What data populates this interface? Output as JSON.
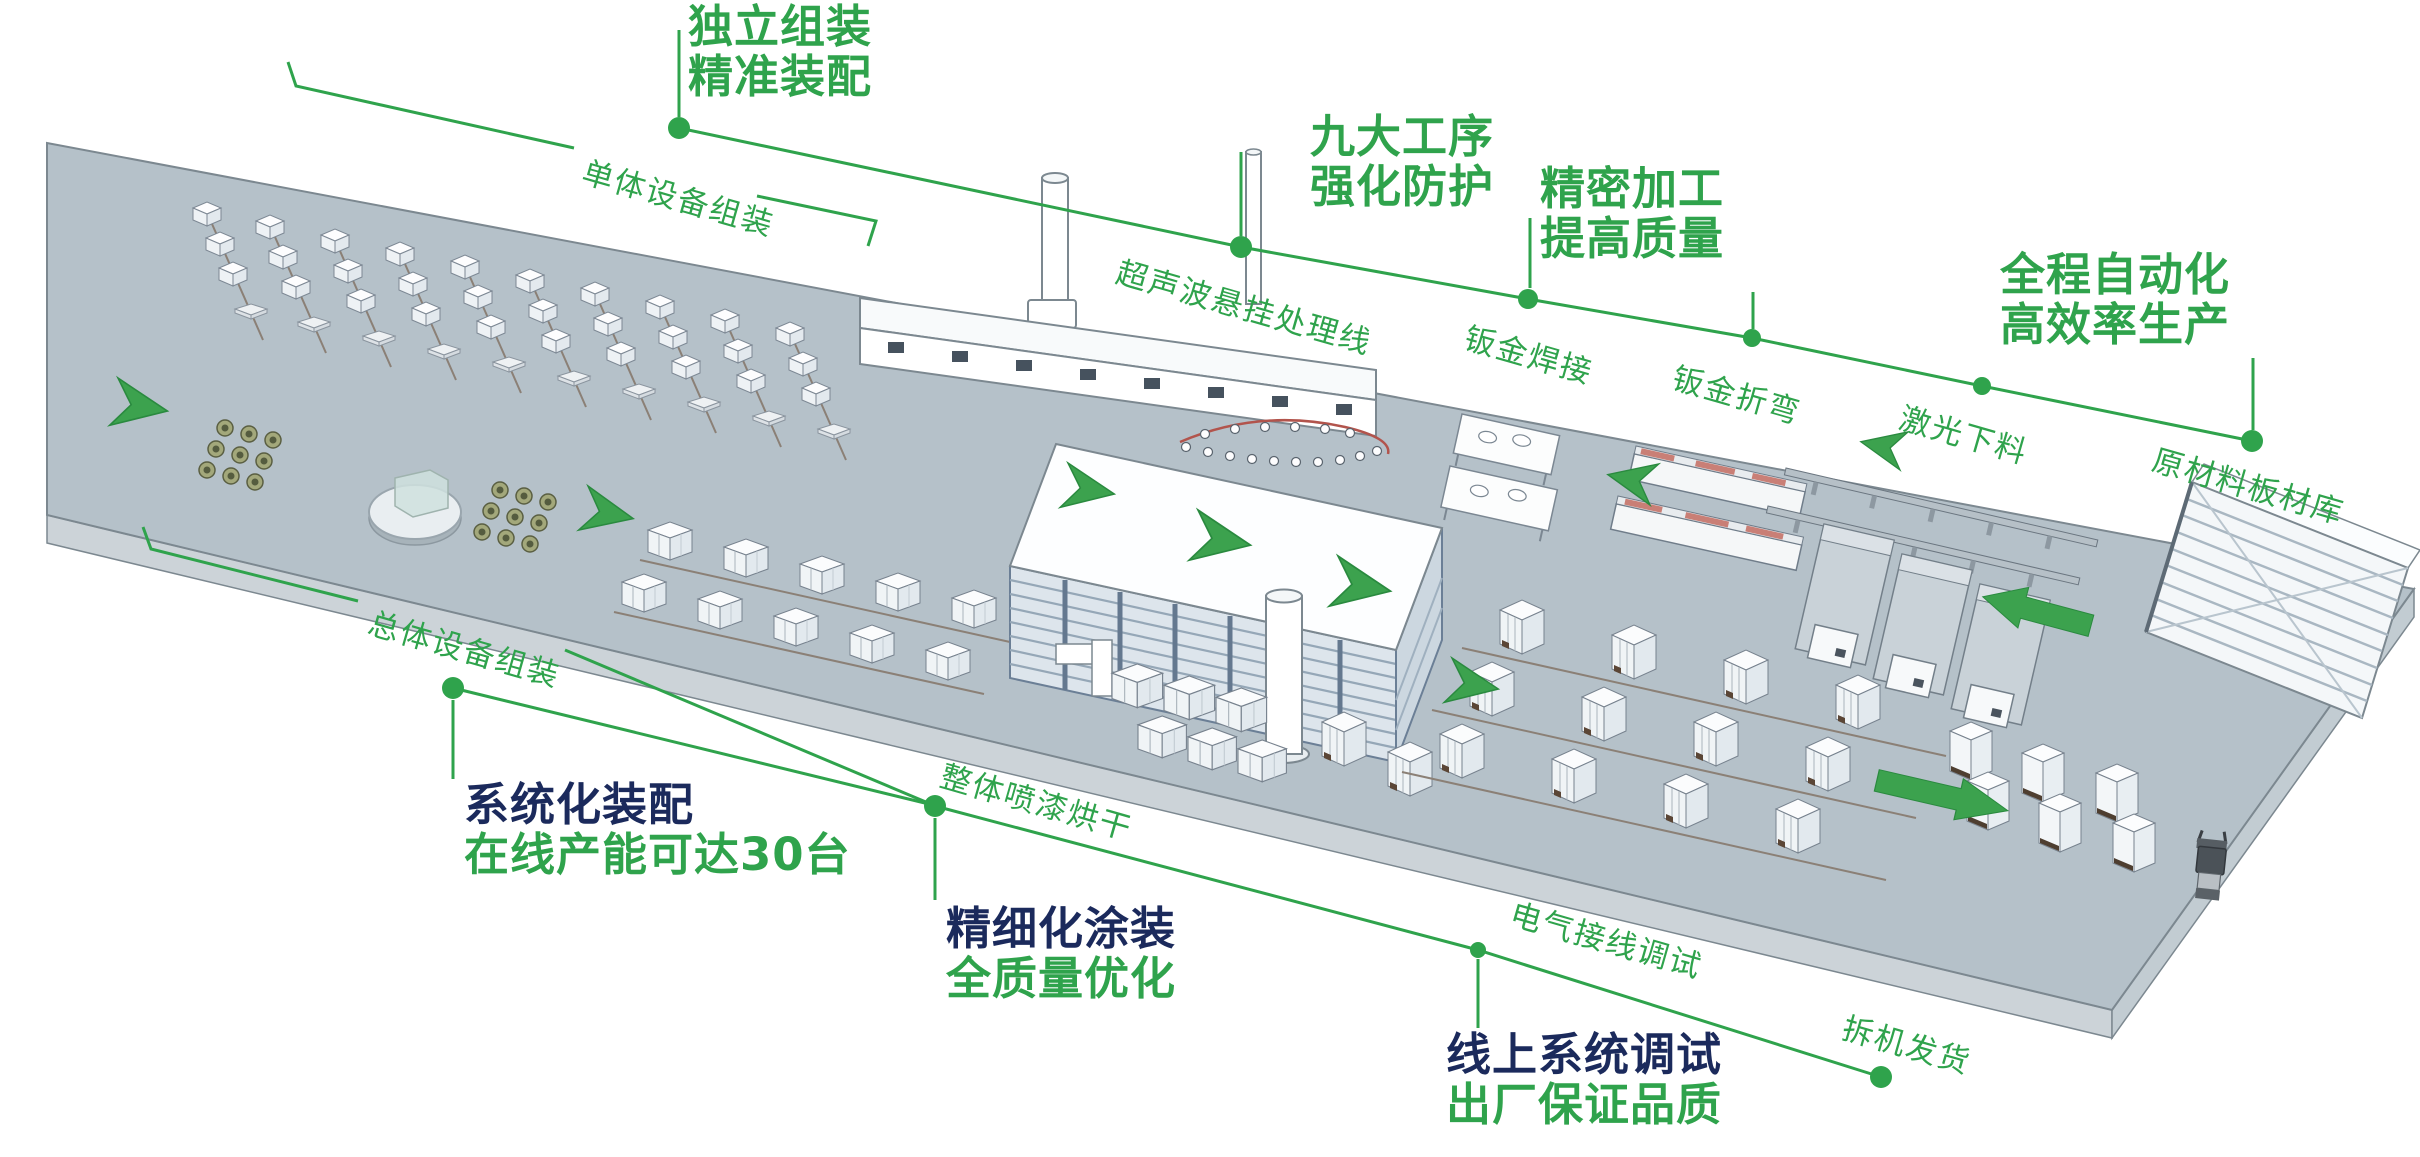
{
  "palette": {
    "accent_green": "#2fa34c",
    "navy": "#1b2a5c",
    "platform_top": "#b5c1c9",
    "platform_side": "#ccd3d8"
  },
  "callouts": {
    "independent": {
      "line1": "独立组装",
      "line2": "精准装配"
    },
    "nine_processes": {
      "line1": "九大工序",
      "line2": "强化防护"
    },
    "precision": {
      "line1": "精密加工",
      "line2": "提高质量"
    },
    "automation": {
      "line1": "全程自动化",
      "line2": "高效率生产"
    },
    "systematic": {
      "line1": "系统化装配",
      "line2": "在线产能可达30台"
    },
    "fine_coating": {
      "line1": "精细化涂装",
      "line2": "全质量优化"
    },
    "online_debug": {
      "line1": "线上系统调试",
      "line2": "出厂保证品质"
    }
  },
  "stations": {
    "unit_assembly": "单体设备组装",
    "ultrasonic_line": "超声波悬挂处理线",
    "sheet_welding": "钣金焊接",
    "sheet_bending": "钣金折弯",
    "laser_cutting": "激光下料",
    "raw_material": "原材料板材库",
    "overall_assembly": "总体设备组装",
    "spray_drying": "整体喷漆烘干",
    "electric_wiring": "电气接线调试",
    "dismantle_ship": "拆机发货"
  }
}
